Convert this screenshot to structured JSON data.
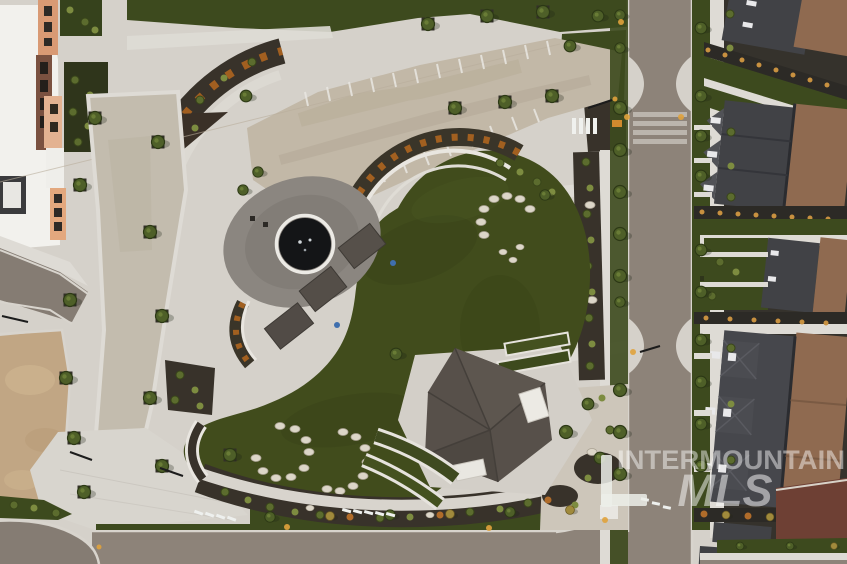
{
  "watermark": {
    "line1": "INTERMOUNTAIN",
    "line2": "MLS",
    "color": "#ffffff",
    "opacity_line1": 0.46,
    "opacity_line2": 0.5
  },
  "scene": {
    "type": "aerial-drone-photograph",
    "subject": "neighborhood park plaza at dusk with circular fountain, crescent event lawn, amphitheater seat walls, large pavilion, boulder gardens, paver festival plaza, street grid and townhome rows",
    "elements": [
      "office-building",
      "garden-beds",
      "paver-festival-plaza",
      "parking-tick-marks",
      "fountain-plaza",
      "fountain-basin",
      "event-lawn",
      "amphitheater-seat-walls",
      "flower-band",
      "pergola-roofs",
      "pavilion-roof",
      "raised-planters",
      "boulder-circles",
      "paver-walkway",
      "dirt-lot",
      "vertical-street",
      "bottom-street",
      "curb-bulbs",
      "crosswalk-markings",
      "street-trees",
      "townhome-row",
      "alley",
      "sidewalks",
      "streetlights"
    ]
  },
  "palette": {
    "concrete": "#d5d1ca",
    "concrete_light": "#dedbd5",
    "paver": "#c2b8a7",
    "road": "#8d8379",
    "dirt": "#c1a684",
    "lawn": "#414c1c",
    "grass_strip": "#3d4a1e",
    "mulch": "#38322a",
    "shrub_green": "#5c6c2e",
    "tree_green": "#4e5f28",
    "tree_gold": "#a08a3c",
    "roof_gray": "#414246",
    "roof_brown": "#8f6a50",
    "roof_red": "#6e4034",
    "pavilion_roof": "#57504a",
    "boulder": "#dcd6c8",
    "flower_orange": "#b5671f",
    "fountain_water": "#141517",
    "amber_light": "#e0a23c",
    "building_white": "#f2f1ed",
    "building_salmon": "#d99a74"
  }
}
